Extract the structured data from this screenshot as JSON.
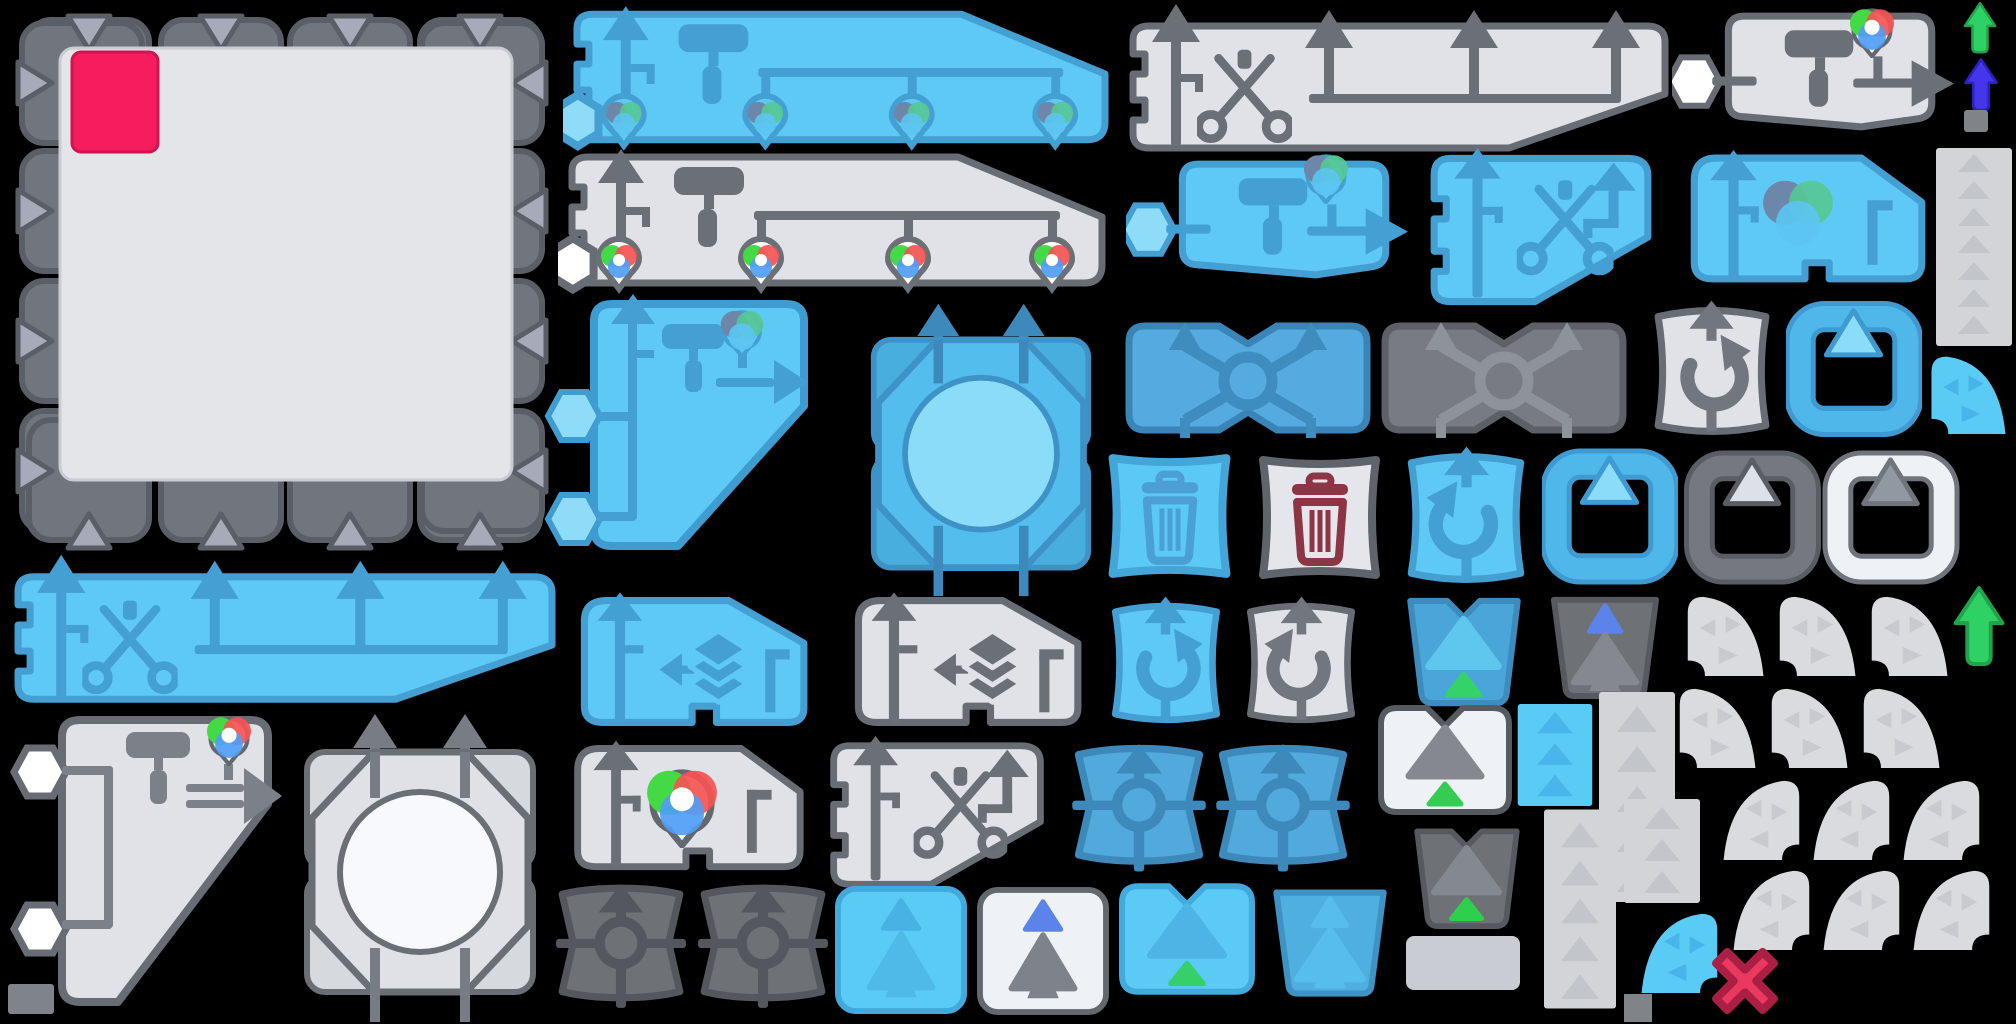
{
  "meta": {
    "kind": "game-sprite-atlas",
    "description": "Texture atlas of editor/game UI sprites on a black background",
    "canvas": {
      "width": 2016,
      "height": 1024
    },
    "background": "#000000"
  },
  "palette": {
    "blue": "#5ec9f5",
    "blueIcon": "#449fd2",
    "blueMed": "#52a9db",
    "blueMedIcon": "#3d89bc",
    "cyan": "#5acbf5",
    "grayFill": "#e0e2e7",
    "grayIcon": "#71767e",
    "grayBorder": "#686d75",
    "darkFill": "#75797f",
    "darkIcon": "#54585e",
    "white": "#eef1f6",
    "tabTriangle": "#a7aab9",
    "panelFill": "#e3e5e9",
    "crimson": "#f51d5e",
    "redX": "#e9395f",
    "redXBorder": "#ab1f44",
    "maroon": "#8c3545",
    "green": "#35d169",
    "greenArrow": "#2ed164",
    "indigo": "#4636e9",
    "periwinkle": "#5b83ea",
    "fanFill": "#d9dbdf",
    "fanTri": "#c7cace",
    "stripFill": "#d2d4d8",
    "stripTri": "#c2c5ca",
    "wheelRed": "#f45353",
    "wheelGreen": "#44da46",
    "wheelBlue": "#4f9df5",
    "wheelMut1": "#6d87ab",
    "wheelMut2": "#57c795",
    "wheelMut3": "#5cc4f0"
  },
  "sprites": [
    {
      "name": "canvas-panel",
      "color": "gray",
      "icons": [
        "tab-triangle-icon",
        "crimson-swatch"
      ]
    },
    {
      "name": "banner-paint-blue",
      "color": "blue",
      "icons": [
        "up-arrow-icon",
        "paint-roller-icon",
        "rgb-wheel-icon",
        "rgb-wheel-icon",
        "rgb-wheel-icon",
        "rgb-wheel-icon",
        "hexagon-node-icon"
      ]
    },
    {
      "name": "banner-paint-gray",
      "color": "gray",
      "icons": [
        "up-arrow-icon",
        "paint-roller-icon",
        "rgb-wheel-icon",
        "rgb-wheel-icon",
        "rgb-wheel-icon",
        "rgb-wheel-icon",
        "hexagon-node-icon"
      ]
    },
    {
      "name": "banner-cut-gray",
      "color": "gray",
      "icons": [
        "up-arrow-icon",
        "scissors-icon",
        "up-arrow-icon",
        "up-arrow-icon",
        "up-arrow-icon"
      ]
    },
    {
      "name": "shape-roller-gray",
      "color": "gray",
      "icons": [
        "hexagon-node-icon",
        "paint-roller-icon",
        "rgb-wheel-icon",
        "right-arrow-icon"
      ]
    },
    {
      "name": "arrow-green-small",
      "color": "green",
      "icons": [
        "up-arrow-icon"
      ]
    },
    {
      "name": "arrow-indigo",
      "color": "indigo",
      "icons": [
        "up-arrow-icon"
      ]
    },
    {
      "name": "tiny-square-top-right",
      "color": "gray",
      "icons": []
    },
    {
      "name": "shape-roller-blue",
      "color": "blue",
      "icons": [
        "hexagon-node-icon",
        "paint-roller-icon",
        "rgb-wheel-icon",
        "right-arrow-icon"
      ]
    },
    {
      "name": "shape-cut-blue",
      "color": "blue",
      "icons": [
        "up-arrow-icon",
        "scissors-icon",
        "hook-arrow-icon"
      ]
    },
    {
      "name": "shape-ball-blue",
      "color": "blue",
      "icons": [
        "up-arrow-icon",
        "rgb-wheel-icon",
        "hook-line-icon"
      ]
    },
    {
      "name": "strip-arrows-right",
      "color": "gray",
      "icons": [
        "up-triangle-icon"
      ]
    },
    {
      "name": "shape-roller-arrow-blue",
      "color": "blue",
      "icons": [
        "hexagon-node-icon",
        "up-arrow-icon",
        "paint-roller-icon",
        "rgb-wheel-icon",
        "right-arrow-icon"
      ]
    },
    {
      "name": "octagon-turret-blue",
      "color": "blue",
      "icons": [
        "up-arrow-icon",
        "up-arrow-icon",
        "circle-icon"
      ]
    },
    {
      "name": "cross-swap-blue",
      "color": "blue-medium",
      "icons": [
        "cross-arrows-icon",
        "circle-icon"
      ]
    },
    {
      "name": "cross-swap-dark",
      "color": "dark-gray",
      "icons": [
        "cross-arrows-icon",
        "circle-icon"
      ]
    },
    {
      "name": "rotate-cw-white",
      "color": "white",
      "icons": [
        "up-arrow-icon",
        "rotate-clockwise-icon"
      ]
    },
    {
      "name": "frame-blue-1",
      "color": "blue",
      "icons": [
        "up-triangle-icon"
      ]
    },
    {
      "name": "fan-blue-1",
      "color": "blue",
      "icons": [
        "sweep-triangles-icon"
      ]
    },
    {
      "name": "trash-blue",
      "color": "blue",
      "icons": [
        "trash-icon"
      ]
    },
    {
      "name": "trash-white-red",
      "color": "white",
      "icons": [
        "trash-icon"
      ]
    },
    {
      "name": "rotate-ccw-blue",
      "color": "blue",
      "icons": [
        "up-arrow-icon",
        "rotate-counterclockwise-icon"
      ]
    },
    {
      "name": "frame-blue-2",
      "color": "blue",
      "icons": [
        "up-triangle-icon"
      ]
    },
    {
      "name": "frame-dark",
      "color": "dark-gray",
      "icons": [
        "up-triangle-icon"
      ]
    },
    {
      "name": "frame-white",
      "color": "white",
      "icons": [
        "up-triangle-icon"
      ]
    },
    {
      "name": "banner-cut-blue",
      "color": "blue",
      "icons": [
        "up-arrow-icon",
        "scissors-icon",
        "up-arrow-icon",
        "up-arrow-icon",
        "up-arrow-icon"
      ]
    },
    {
      "name": "shape-layers-blue",
      "color": "blue",
      "icons": [
        "up-arrow-icon",
        "left-arrow-icon",
        "layer-stack-icon",
        "hook-line-icon"
      ]
    },
    {
      "name": "shape-layers-gray",
      "color": "gray",
      "icons": [
        "up-arrow-icon",
        "left-arrow-icon",
        "layer-stack-icon",
        "hook-line-icon"
      ]
    },
    {
      "name": "rotate-cw-blue",
      "color": "blue",
      "icons": [
        "up-arrow-icon",
        "rotate-clockwise-icon"
      ]
    },
    {
      "name": "rotate-ccw-white",
      "color": "white",
      "icons": [
        "up-arrow-icon",
        "rotate-counterclockwise-icon"
      ]
    },
    {
      "name": "bucket-blue-green",
      "color": "blue-medium",
      "icons": [
        "notched-triangle-icon",
        "green-triangle-icon"
      ]
    },
    {
      "name": "bucket-dark-tree",
      "color": "dark-gray",
      "icons": [
        "periwinkle-triangle-icon",
        "gray-triangle-icon"
      ]
    },
    {
      "name": "fan-gray-grid1",
      "color": "gray",
      "count": 6,
      "icons": [
        "sweep-triangles-icon"
      ]
    },
    {
      "name": "arrow-green-big",
      "color": "green",
      "icons": [
        "up-arrow-icon"
      ]
    },
    {
      "name": "shape-pipes-gray-large",
      "color": "gray",
      "icons": [
        "hexagon-node-icon",
        "hexagon-node-icon",
        "paint-roller-icon",
        "rgb-wheel-icon",
        "double-right-arrow-icon"
      ]
    },
    {
      "name": "tiny-square-bottom-left",
      "color": "gray",
      "icons": []
    },
    {
      "name": "octagon-turret-gray",
      "color": "gray",
      "icons": [
        "up-arrow-icon",
        "up-arrow-icon",
        "circle-icon"
      ]
    },
    {
      "name": "shape-ball-white",
      "color": "white",
      "icons": [
        "up-arrow-icon",
        "rgb-wheel-icon",
        "hook-line-icon"
      ]
    },
    {
      "name": "shape-cut-gray",
      "color": "gray",
      "icons": [
        "up-arrow-icon",
        "scissors-icon",
        "hook-arrow-icon"
      ]
    },
    {
      "name": "turret-blue-1",
      "color": "blue-medium",
      "icons": [
        "up-arrow-icon",
        "crosshair-circle-icon"
      ]
    },
    {
      "name": "turret-blue-2",
      "color": "blue-medium",
      "icons": [
        "up-arrow-icon",
        "crosshair-circle-icon"
      ]
    },
    {
      "name": "square-white-green",
      "color": "white",
      "icons": [
        "notched-triangle-icon",
        "green-triangle-icon"
      ]
    },
    {
      "name": "strip-blue",
      "color": "blue",
      "icons": [
        "up-triangle-icon"
      ]
    },
    {
      "name": "strip-gray-b",
      "color": "gray",
      "icons": [
        "up-triangle-icon"
      ]
    },
    {
      "name": "strip-gray-c",
      "color": "gray",
      "icons": [
        "up-triangle-icon"
      ]
    },
    {
      "name": "strip-gray-d",
      "color": "gray",
      "icons": [
        "up-triangle-icon"
      ]
    },
    {
      "name": "bucket-dark-green",
      "color": "dark-gray",
      "icons": [
        "notched-triangle-icon",
        "green-triangle-icon"
      ]
    },
    {
      "name": "turret-gray-1",
      "color": "dark-gray",
      "icons": [
        "up-arrow-icon",
        "crosshair-circle-icon"
      ]
    },
    {
      "name": "turret-gray-2",
      "color": "dark-gray",
      "icons": [
        "up-arrow-icon",
        "crosshair-circle-icon"
      ]
    },
    {
      "name": "square-blue-tree",
      "color": "blue",
      "icons": [
        "small-triangle-icon",
        "big-triangle-icon"
      ]
    },
    {
      "name": "square-white-tree",
      "color": "white",
      "icons": [
        "periwinkle-triangle-icon",
        "gray-triangle-icon"
      ]
    },
    {
      "name": "square-blue-green",
      "color": "blue",
      "icons": [
        "notched-triangle-icon",
        "green-triangle-icon"
      ]
    },
    {
      "name": "bucket-blue-tree",
      "color": "blue-medium",
      "icons": [
        "small-triangle-icon",
        "big-triangle-icon"
      ]
    },
    {
      "name": "strip-plain-short",
      "color": "gray",
      "icons": []
    },
    {
      "name": "fan-blue-2",
      "color": "blue",
      "icons": [
        "sweep-triangles-icon"
      ]
    },
    {
      "name": "tiny-square-fan",
      "color": "gray",
      "icons": []
    },
    {
      "name": "red-x-marker",
      "color": "red",
      "icons": [
        "x-icon"
      ]
    },
    {
      "name": "fan-gray-grid2",
      "color": "gray",
      "count": 6,
      "icons": [
        "sweep-triangles-icon"
      ]
    }
  ]
}
